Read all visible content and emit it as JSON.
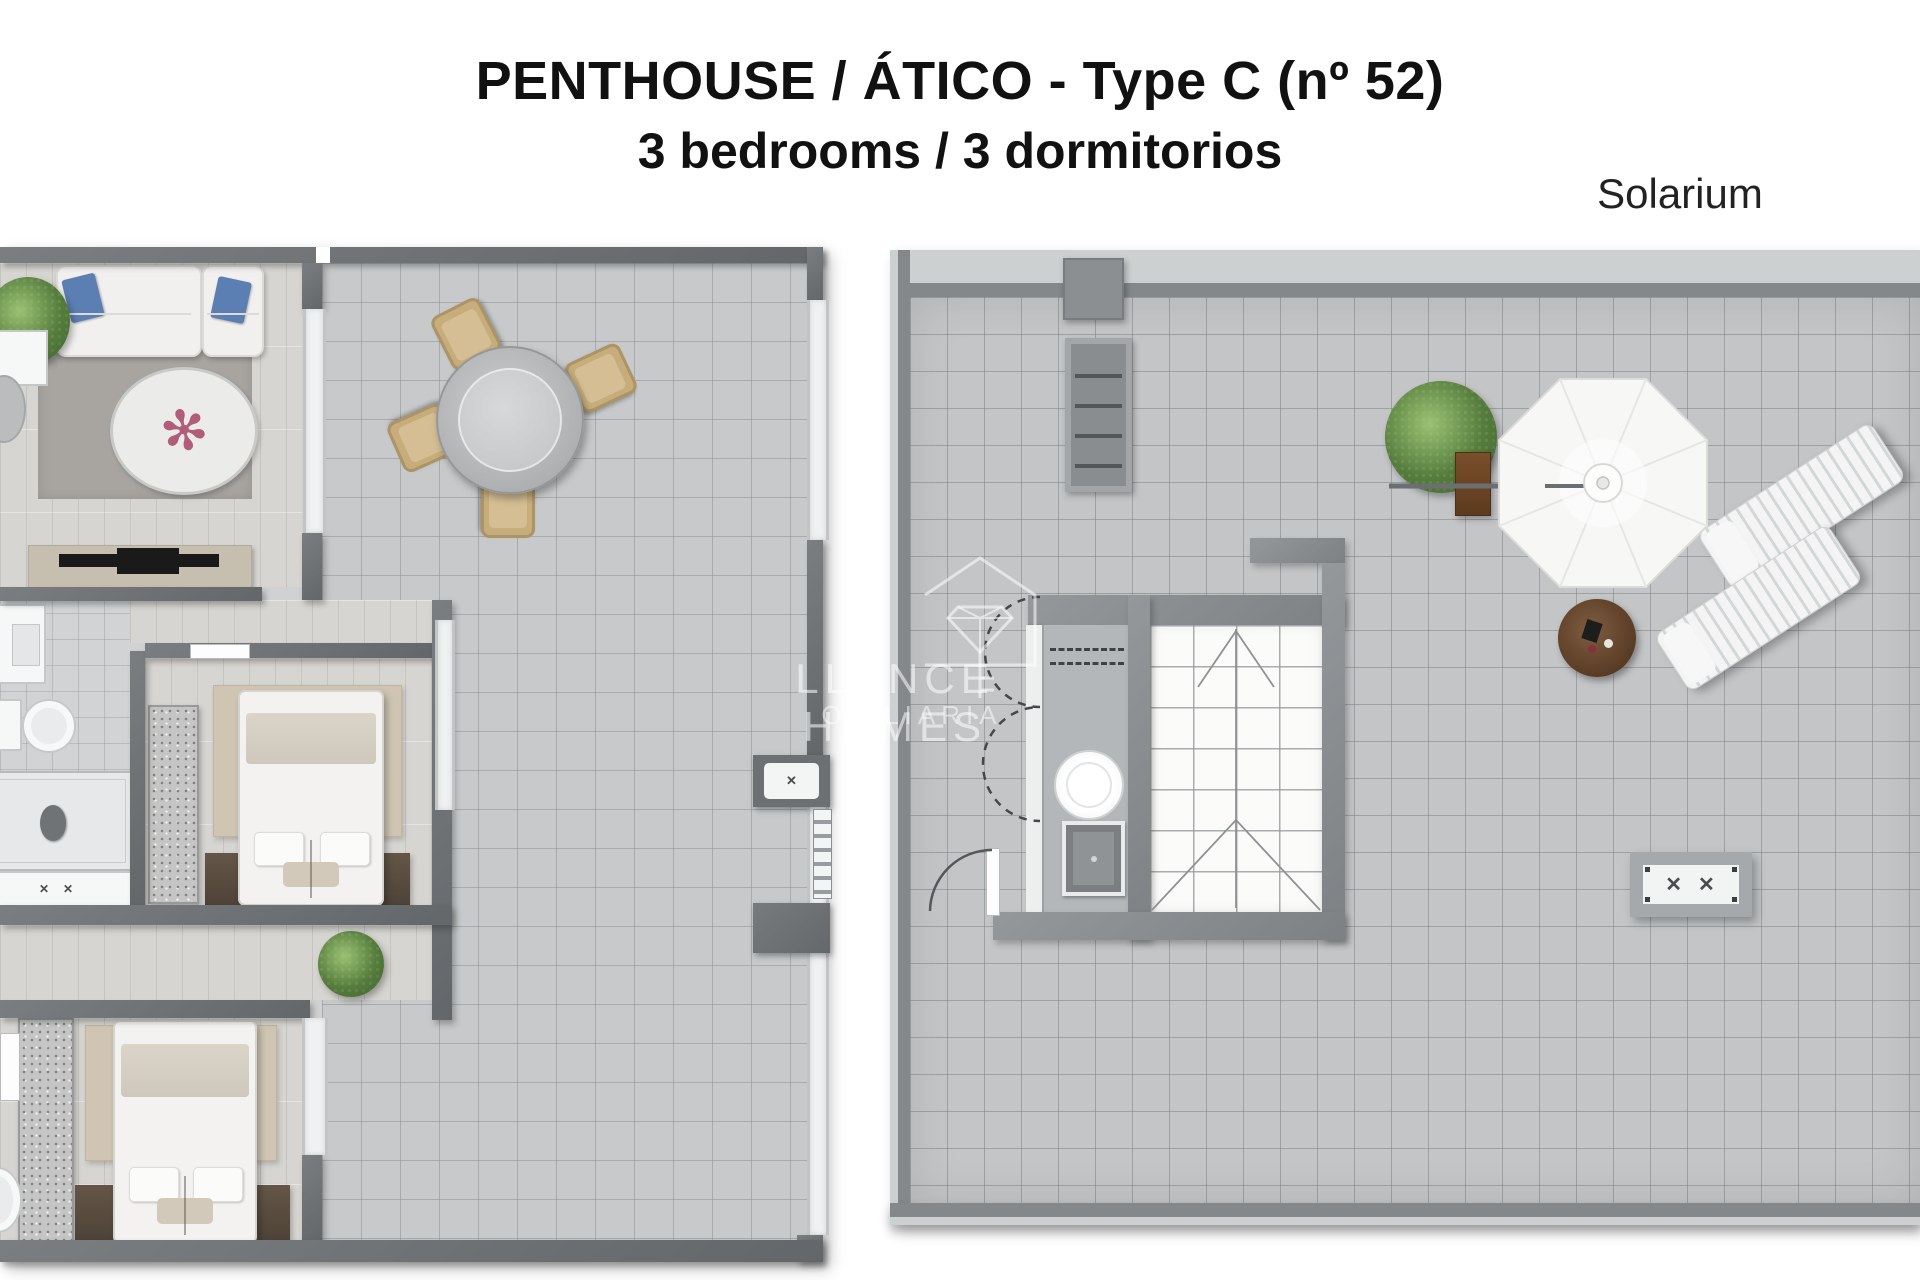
{
  "title": {
    "line1": "PENTHOUSE / ÁTICO - Type C (nº 52)",
    "line2": "3 bedrooms / 3 dormitorios"
  },
  "labels": {
    "solarium": "Solarium"
  },
  "watermark": {
    "line1": "LLANCE HOMES",
    "line2": "OBILIARIA"
  },
  "icons": {
    "x_mark": "✕",
    "flower": "✻"
  },
  "colors": {
    "wall_dark": "#6e7275",
    "wall_light": "#cdd0d1",
    "tile_floor": "#c5c7c9",
    "plank_floor": "#d7d5d1",
    "rug_beige": "#cfc5b2",
    "floor_brown": "#5a4e42",
    "cushion_blue": "#5b7fb3",
    "plant_green": "#5f8444",
    "planter_brown": "#6f4826",
    "text_black": "#111111",
    "watermark_white": "#ffffff"
  },
  "plans": {
    "apartment": {
      "rooms": [
        "living-room",
        "terrace",
        "bathroom",
        "bedroom-1",
        "hallway",
        "bedroom-2"
      ],
      "furniture": [
        "sofa",
        "armchair",
        "round-rug",
        "tv-unit",
        "dining-table-with-chairs",
        "washbasin",
        "toilet",
        "shower",
        "bathtub",
        "wardrobe",
        "double-bed",
        "plants",
        "fold-out-unit"
      ]
    },
    "solarium": {
      "features": [
        "staircase-skylight",
        "spiral-stair-indication",
        "outdoor-kitchen-counter",
        "barbecue",
        "parasol",
        "sun-loungers",
        "side-table",
        "planter",
        "storage-bench",
        "fold-out-table",
        "access-door"
      ]
    }
  }
}
